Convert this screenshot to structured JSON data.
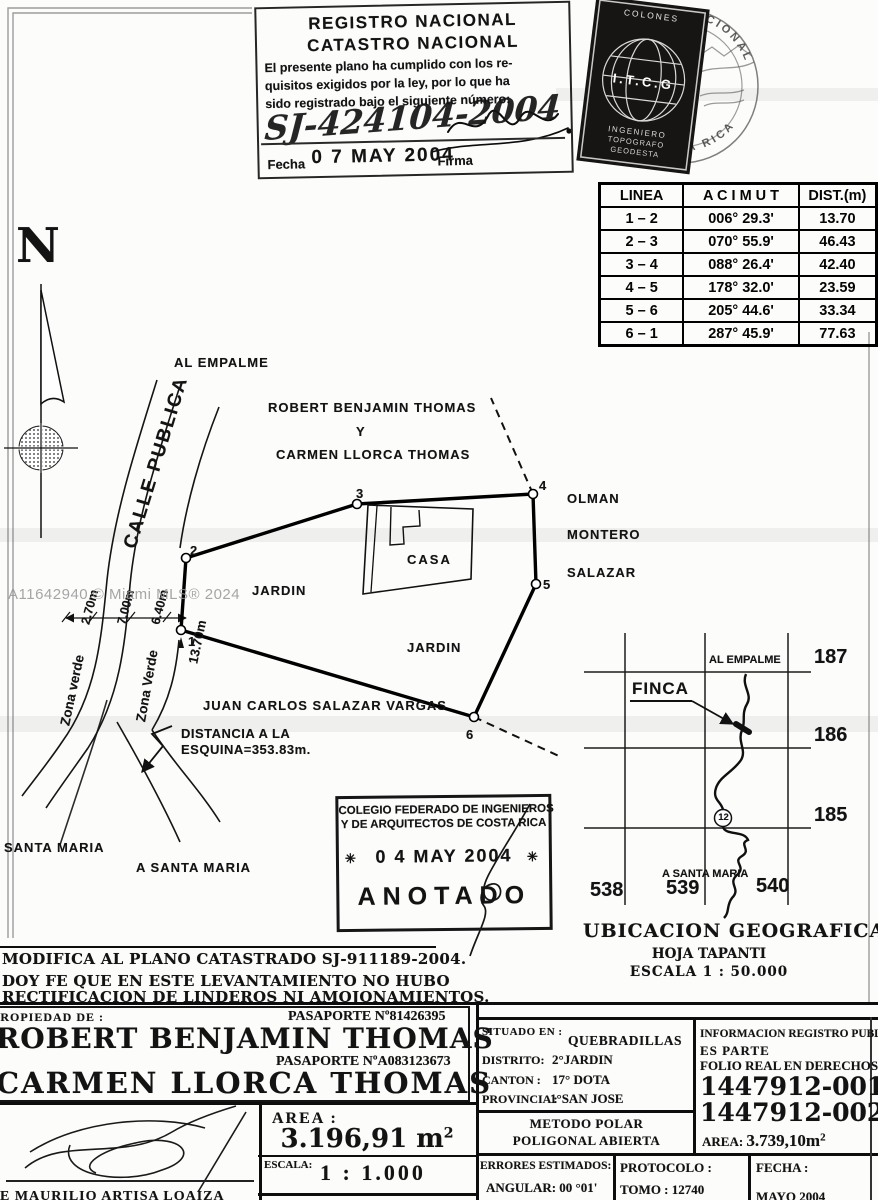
{
  "watermark": "A11642940 © Miami MLS® 2024",
  "north_label": "N",
  "registro_stamp": {
    "title1": "REGISTRO NACIONAL",
    "title2": "CATASTRO NACIONAL",
    "body1": "El presente plano ha cumplido con los re-",
    "body2": "quisitos exigidos por la ley, por lo que ha",
    "body3": "sido registrado bajo el siguiente número:",
    "number": "SJ-424104-2004",
    "date": "0 7 MAY 2004",
    "fecha_label": "Fecha",
    "firma_label": "Firma"
  },
  "seal": {
    "ring_top": "REGISTRO NACIONAL",
    "ring_bottom": "DE COSTA RICA",
    "colones": "COLONES",
    "initials": "I.T.C.G",
    "line1": "INGENIERO",
    "line2": "TOPOGRAFO",
    "line3": "GEODESTA"
  },
  "azimuth_table": {
    "headers": [
      "LINEA",
      "A C I M U T",
      "DIST.(m)"
    ],
    "rows": [
      {
        "linea": "1 – 2",
        "acimut": "006° 29.3'",
        "dist": "13.70"
      },
      {
        "linea": "2 – 3",
        "acimut": "070° 55.9'",
        "dist": "46.43"
      },
      {
        "linea": "3 – 4",
        "acimut": "088° 26.4'",
        "dist": "42.40"
      },
      {
        "linea": "4 – 5",
        "acimut": "178° 32.0'",
        "dist": "23.59"
      },
      {
        "linea": "5 – 6",
        "acimut": "205° 44.6'",
        "dist": "33.34"
      },
      {
        "linea": "6 – 1",
        "acimut": "287° 45.9'",
        "dist": "77.63"
      }
    ]
  },
  "plan": {
    "al_empalme": "AL EMPALME",
    "calle_publica": "CALLE PUBLICA",
    "owner_line1": "ROBERT BENJAMIN THOMAS",
    "owner_line2": "Y",
    "owner_line3": "CARMEN LLORCA THOMAS",
    "casa": "CASA",
    "jardin_left": "JARDIN",
    "jardin_bottom": "JARDIN",
    "neighbor1": "OLMAN",
    "neighbor2": "MONTERO",
    "neighbor3": "SALAZAR",
    "neighbor_south": "JUAN CARLOS SALAZAR VARGAS",
    "zona_verde_left": "Zona verde",
    "zona_verde_right": "Zona Verde",
    "dim1": "2.70m",
    "dim2": "7.00m",
    "dim3": "6.40m",
    "dim4": "13.70m",
    "dist_line1": "DISTANCIA A LA",
    "dist_line2": "ESQUINA=353.83m.",
    "santa_maria": "SANTA MARIA",
    "a_santa_maria": "A SANTA MARIA",
    "v1": "1",
    "v2": "2",
    "v3": "3",
    "v4": "4",
    "v5": "5",
    "v6": "6"
  },
  "anotado_stamp": {
    "line1": "COLEGIO FEDERADO DE INGENIEROS",
    "line2": "Y DE ARQUITECTOS DE COSTA RICA",
    "star": "✳",
    "date": "0 4 MAY 2004",
    "word": "ANOTADO"
  },
  "location_map": {
    "al_empalme": "AL EMPALME",
    "finca": "FINCA",
    "lat_labels": [
      "187",
      "186",
      "185"
    ],
    "lon_labels": [
      "538",
      "539",
      "540"
    ],
    "a_santa_maria": "A SANTA MARIA",
    "route_badge": "12",
    "title": "UBICACION GEOGRAFICA",
    "sheet": "HOJA TAPANTI",
    "scale": "ESCALA 1 : 50.000"
  },
  "notes": {
    "line1": "MODIFICA AL PLANO CATASTRADO SJ-911189-2004.",
    "line2": "DOY FE QUE EN ESTE LEVANTAMIENTO NO HUBO",
    "line3": "RECTIFICACION DE LINDEROS NI AMOJONAMIENTOS."
  },
  "footer": {
    "propiedad_label": "PROPIEDAD DE :",
    "pasaporte1": "PASAPORTE Nº81426395",
    "owner1": "ROBERT BENJAMIN THOMAS",
    "pasaporte2": "PASAPORTE NºA083123673",
    "owner2": "CARMEN LLORCA THOMAS",
    "surveyor": "E MAURILIO ARTISA LOAIZA",
    "area_label": "AREA :",
    "area_value": "3.196,91 m",
    "area_sup": "2",
    "escala_label": "ESCALA:",
    "escala_value": "1 : 1.000",
    "situado_label": "SITUADO EN :",
    "situado_value": "QUEBRADILLAS",
    "distrito_label": "DISTRITO:",
    "distrito_value": "2°JARDIN",
    "canton_label": "CANTON :",
    "canton_value": "17° DOTA",
    "provincia_label": "PROVINCIA :",
    "provincia_value": "1°SAN JOSE",
    "metodo_line1": "METODO POLAR",
    "metodo_line2": "POLIGONAL ABIERTA",
    "errores_label": "ERRORES ESTIMADOS:",
    "errores_value": "ANGULAR: 00 °01'",
    "protocolo_label": "PROTOCOLO :",
    "tomo": "TOMO : 12740",
    "fecha_label": "FECHA :",
    "fecha_value": "MAYO 2004",
    "info1": "INFORMACION REGISTRO PUBLICO",
    "info2": "ES PARTE",
    "info3": "FOLIO REAL EN DERECHOS",
    "folio1": "1447912-001",
    "folio2": "1447912-002",
    "area2_label": "AREA:",
    "area2_value": "3.739,10m",
    "area2_sup": "2"
  }
}
